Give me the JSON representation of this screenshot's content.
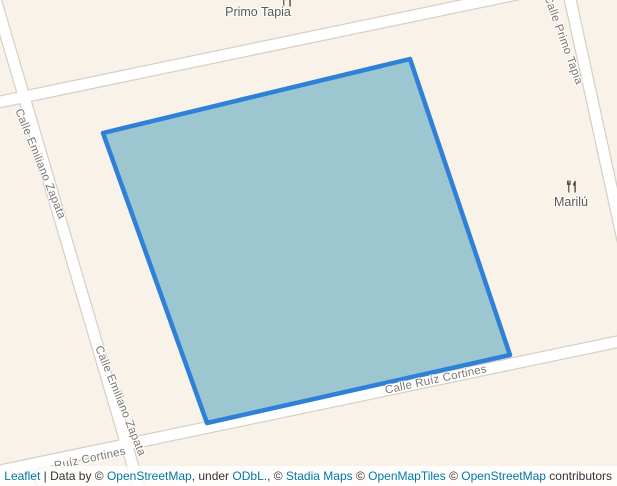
{
  "colors": {
    "map_background": "#f8f2e9",
    "street_fill": "#ffffff",
    "street_casing": "#d6d0c8",
    "street_label": "#7b7672",
    "poi_label": "#5b5854",
    "poi_icon": "#3f3c39",
    "polygon_stroke": "#2e80d8",
    "polygon_fill": "#9cc7d0",
    "attribution_link": "#0078a8"
  },
  "streets": {
    "emiliano_zapata": {
      "name": "Calle Emiliano Zapata"
    },
    "primo_tapia": {
      "name": "Calle Primo Tapia"
    },
    "ruiz_cortines": {
      "name": "Calle Ruíz Cortines"
    },
    "ruiz_cortines_short": {
      "name": "Ruíz Cortines"
    }
  },
  "pois": {
    "primo_tapia": {
      "name": "Primo Tapia",
      "icon": "restaurant-icon"
    },
    "marilu": {
      "name": "Marilú",
      "icon": "restaurant-icon"
    }
  },
  "polygon": {
    "points": "410,59 510,355 207,423 103,133"
  },
  "attribution": {
    "segments": [
      {
        "text": "Leaflet",
        "link": true
      },
      {
        "text": " | Data by © ",
        "link": false
      },
      {
        "text": "OpenStreetMap",
        "link": true
      },
      {
        "text": ", under ",
        "link": false
      },
      {
        "text": "ODbL.",
        "link": true
      },
      {
        "text": ", © ",
        "link": false
      },
      {
        "text": "Stadia Maps",
        "link": true
      },
      {
        "text": " © ",
        "link": false
      },
      {
        "text": "OpenMapTiles",
        "link": true
      },
      {
        "text": " © ",
        "link": false
      },
      {
        "text": "OpenStreetMap",
        "link": true
      },
      {
        "text": " contributors",
        "link": false
      }
    ]
  }
}
